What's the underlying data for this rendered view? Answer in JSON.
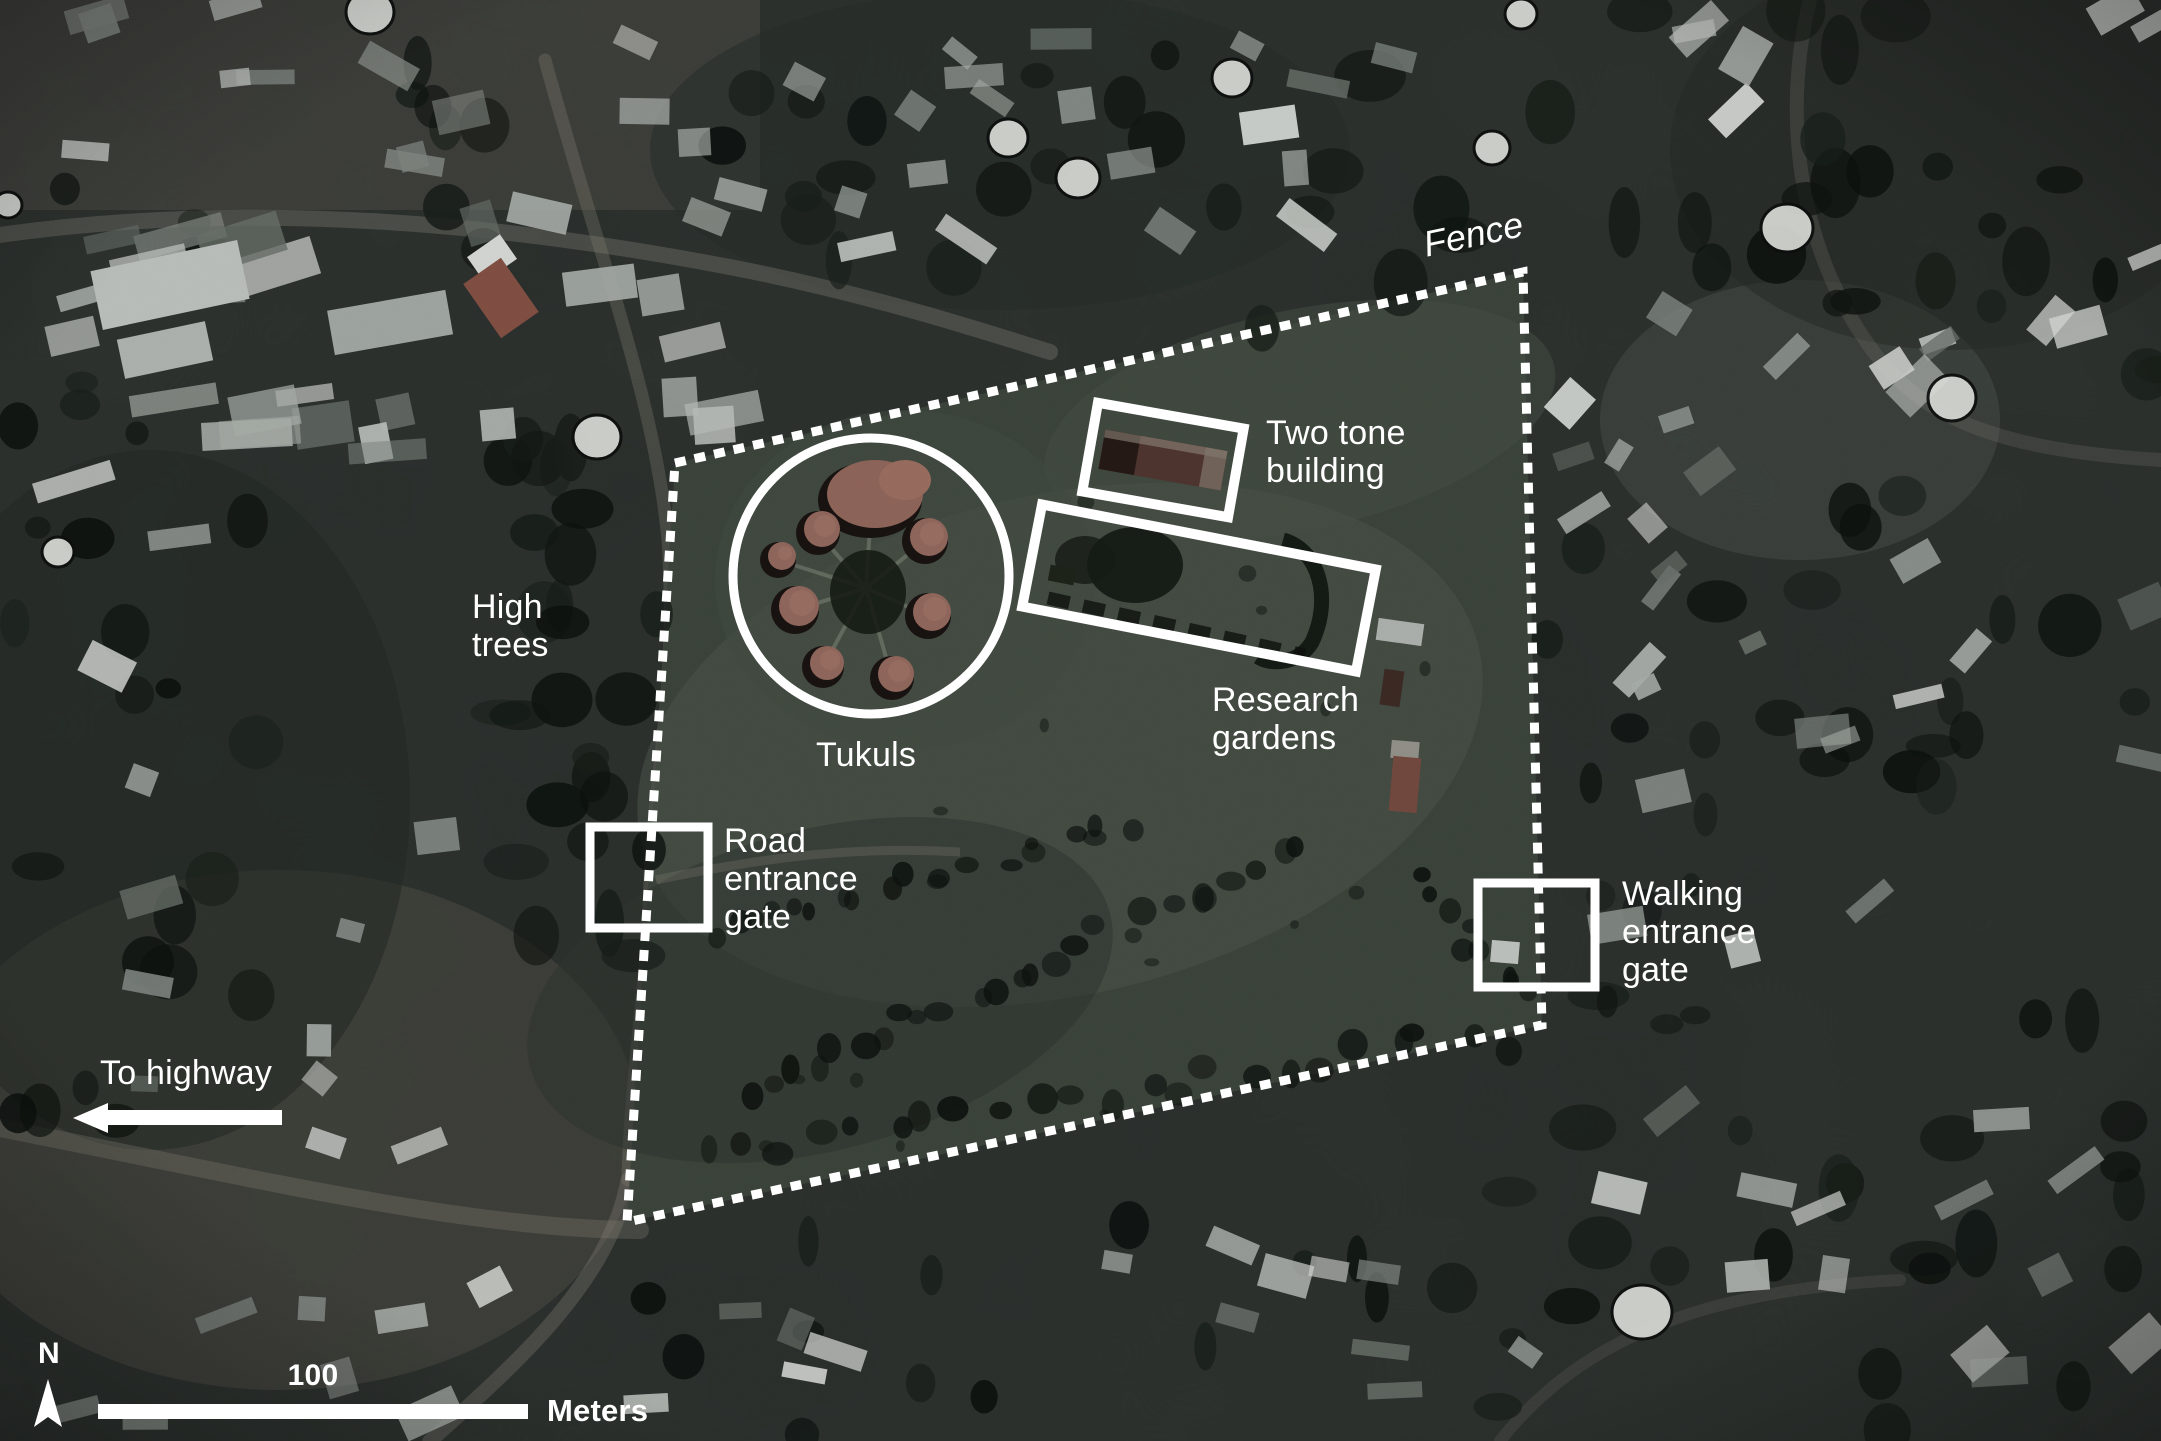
{
  "map": {
    "labels": {
      "fence": "Fence",
      "two_tone_building": "Two tone\nbuilding",
      "tukuls": "Tukuls",
      "research_gardens": "Research\ngardens",
      "high_trees": "High\ntrees",
      "road_entrance_gate": "Road\nentrance\ngate",
      "walking_entrance_gate": "Walking\nentrance\ngate",
      "to_highway": "To highway"
    },
    "scale_bar": {
      "distance": "100",
      "unit": "Meters"
    },
    "compass": {
      "north": "N"
    },
    "colors": {
      "annotation": "#ffffff"
    }
  }
}
